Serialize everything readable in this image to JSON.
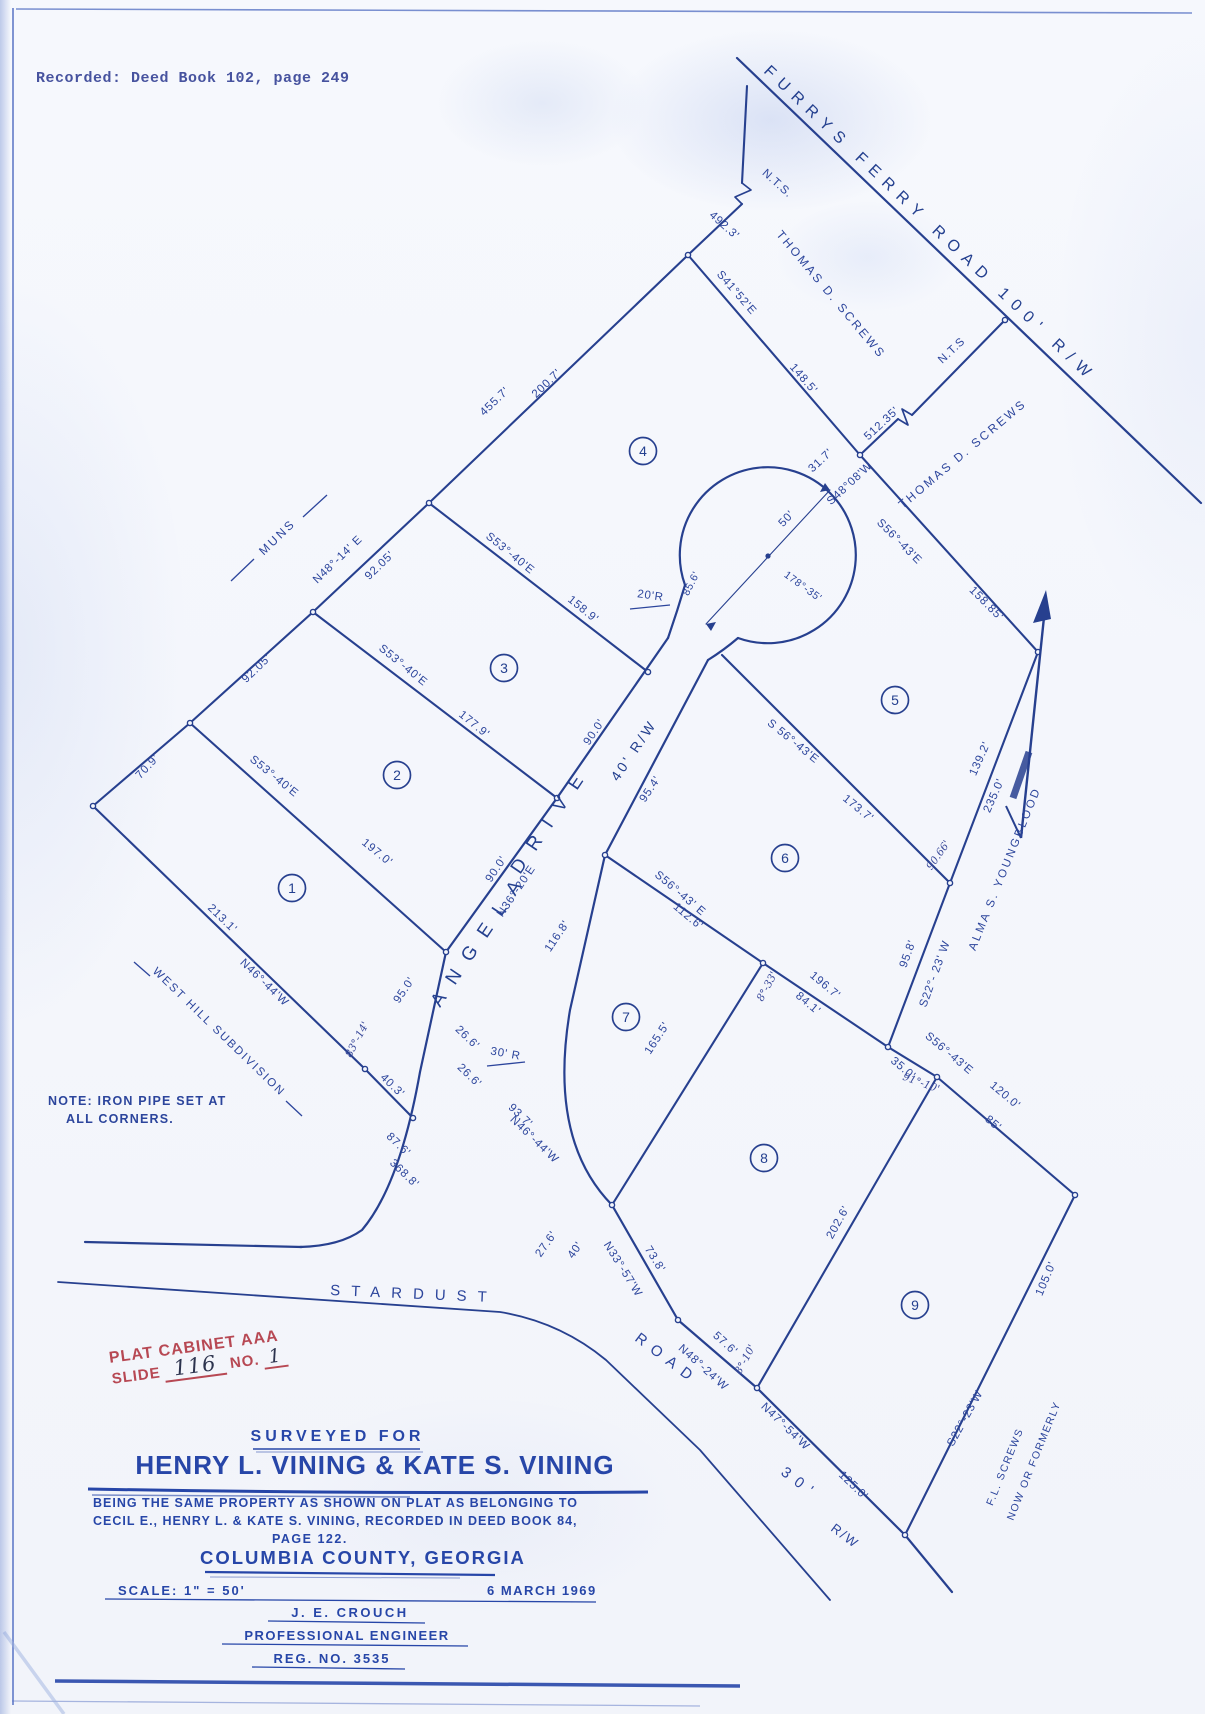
{
  "document": {
    "recorded_stamp": "Recorded: Deed Book 102, page 249",
    "note_line1": "NOTE: IRON PIPE SET AT",
    "note_line2": "ALL CORNERS."
  },
  "cabinet_stamp": {
    "line1": "PLAT CABINET AAA",
    "slide_label": "SLIDE",
    "slide_value": "116",
    "no_label": "NO.",
    "no_value": "1"
  },
  "title_block": {
    "surveyed_for": "SURVEYED FOR",
    "owners": "HENRY L. VINING & KATE S. VINING",
    "description_line1": "BEING THE SAME PROPERTY AS SHOWN ON PLAT AS BELONGING TO",
    "description_line2": "CECIL E., HENRY L. & KATE S. VINING, RECORDED IN DEED BOOK 84,",
    "description_line3": "PAGE 122.",
    "county": "COLUMBIA COUNTY, GEORGIA",
    "scale": "SCALE: 1\" = 50'",
    "date": "6 MARCH 1969",
    "engineer_name": "J. E. CROUCH",
    "engineer_title": "PROFESSIONAL ENGINEER",
    "engineer_reg": "REG. NO. 3535"
  },
  "roads": {
    "furrys_ferry": "FURRYS  FERRY  ROAD  100' R/W",
    "angela_word1": "ANGELA",
    "angela_word2": "DRIVE",
    "angela_rw": "40' R/W",
    "stardust": "STARDUST",
    "stardust_road": "ROAD",
    "stardust_rw_1": "30'",
    "stardust_rw_2": "R/W"
  },
  "adjoiners": {
    "muns": "MUNS",
    "west_hill": "WEST HILL SUBDIVISION",
    "thomas_screws_1": "THOMAS D. SCREWS",
    "thomas_screws_2": "THOMAS D. SCREWS",
    "alma_youngblood": "ALMA S. YOUNGBLOOD",
    "now_or_formerly_1": "NOW OR FORMERLY",
    "now_or_formerly_2": "F.L. SCREWS"
  },
  "lot_numbers": [
    "1",
    "2",
    "3",
    "4",
    "5",
    "6",
    "7",
    "8",
    "9"
  ],
  "dims": {
    "nts_top": "N.T.S.",
    "len_492_3": "492.3'",
    "brg_s41_52e": "S41°52'E",
    "len_148_5": "148.5'",
    "len_31_7": "31.7'",
    "brg_s48_08w": "S48°08'W",
    "len_512_35": "512.35'",
    "nts_right": "N.T.S",
    "len_455_7": "455.7'",
    "len_200_7": "200.7'",
    "brg_n48_14e": "N48°-14' E",
    "len_92_05_a": "92.05'",
    "len_92_05_b": "92.05'",
    "len_70_9": "70.9'",
    "brg_s53_40e_a": "S53°-40'E",
    "len_158_9": "158.9'",
    "brg_s53_40e_b": "S53°-40'E",
    "len_177_9": "177.9'",
    "brg_s53_40e_c": "S53°-40'E",
    "len_197_0": "197.0'",
    "len_213_1": "213.1'",
    "brg_n46_44w_a": "N46°-44'W",
    "len_95_0": "95.0'",
    "len_40_3": "40.3'",
    "len_87_6": "87.6'",
    "len_368_8": "368.8'",
    "len_27_6": "27.6'",
    "len_40": "40'",
    "len_26_6_a": "26.6'",
    "len_26_6_b": "26.6'",
    "rad_30": "30' R",
    "brg_n46_44w_b": "N46°-44'W",
    "len_93_7": "93.7'",
    "brg_n33_57w": "N33°-57'W",
    "len_73_8": "73.8'",
    "len_57_6": "57.6'",
    "brg_n48_24w": "N48°-24'W",
    "brg_n47_54w": "N47°-54'W",
    "len_125_0": "125.0'",
    "rad_20": "20'R",
    "len_50": "50'",
    "len_85_6": "85.6'",
    "ang_178_35": "178°-35'",
    "brg_s56_43e_a": "S56°-43'E",
    "len_158_85": "158.85'",
    "len_139_2": "139.2'",
    "len_235_0": "235.0'",
    "brg_s56_43e_b": "S 56°-43'E",
    "len_173_7": "173.7'",
    "brg_s22_23w_a": "S22°- 23' W",
    "len_95_8": "95.8'",
    "brg_s56_43e_c": "S56°-43' E",
    "len_112_6": "112.6'",
    "len_196_7": "196.7'",
    "len_84_1": "84.1'",
    "len_165_5": "165.5'",
    "brg_s56_43e_d": "S56°-43'E",
    "len_35_0": "35.0'",
    "len_120_0": "120.0'",
    "len_85": "85'",
    "len_202_6": "202.6'",
    "len_105_0": "105.0'",
    "brg_s22_23w_b": "S22°-23'W",
    "len_90_0_a": "90.0'",
    "len_90_0_b": "90.0'",
    "brg_n36_20e": "N36°-20'E",
    "len_95_4": "95.4'",
    "len_116_8": "116.8'"
  },
  "handwritten": {
    "hw_83_14": "83°-14'",
    "hw_8_33": "8°-33'",
    "hw_90_66": "90.66'",
    "hw_91_10": "91°-10'",
    "hw_8_10": "8°-10'"
  }
}
